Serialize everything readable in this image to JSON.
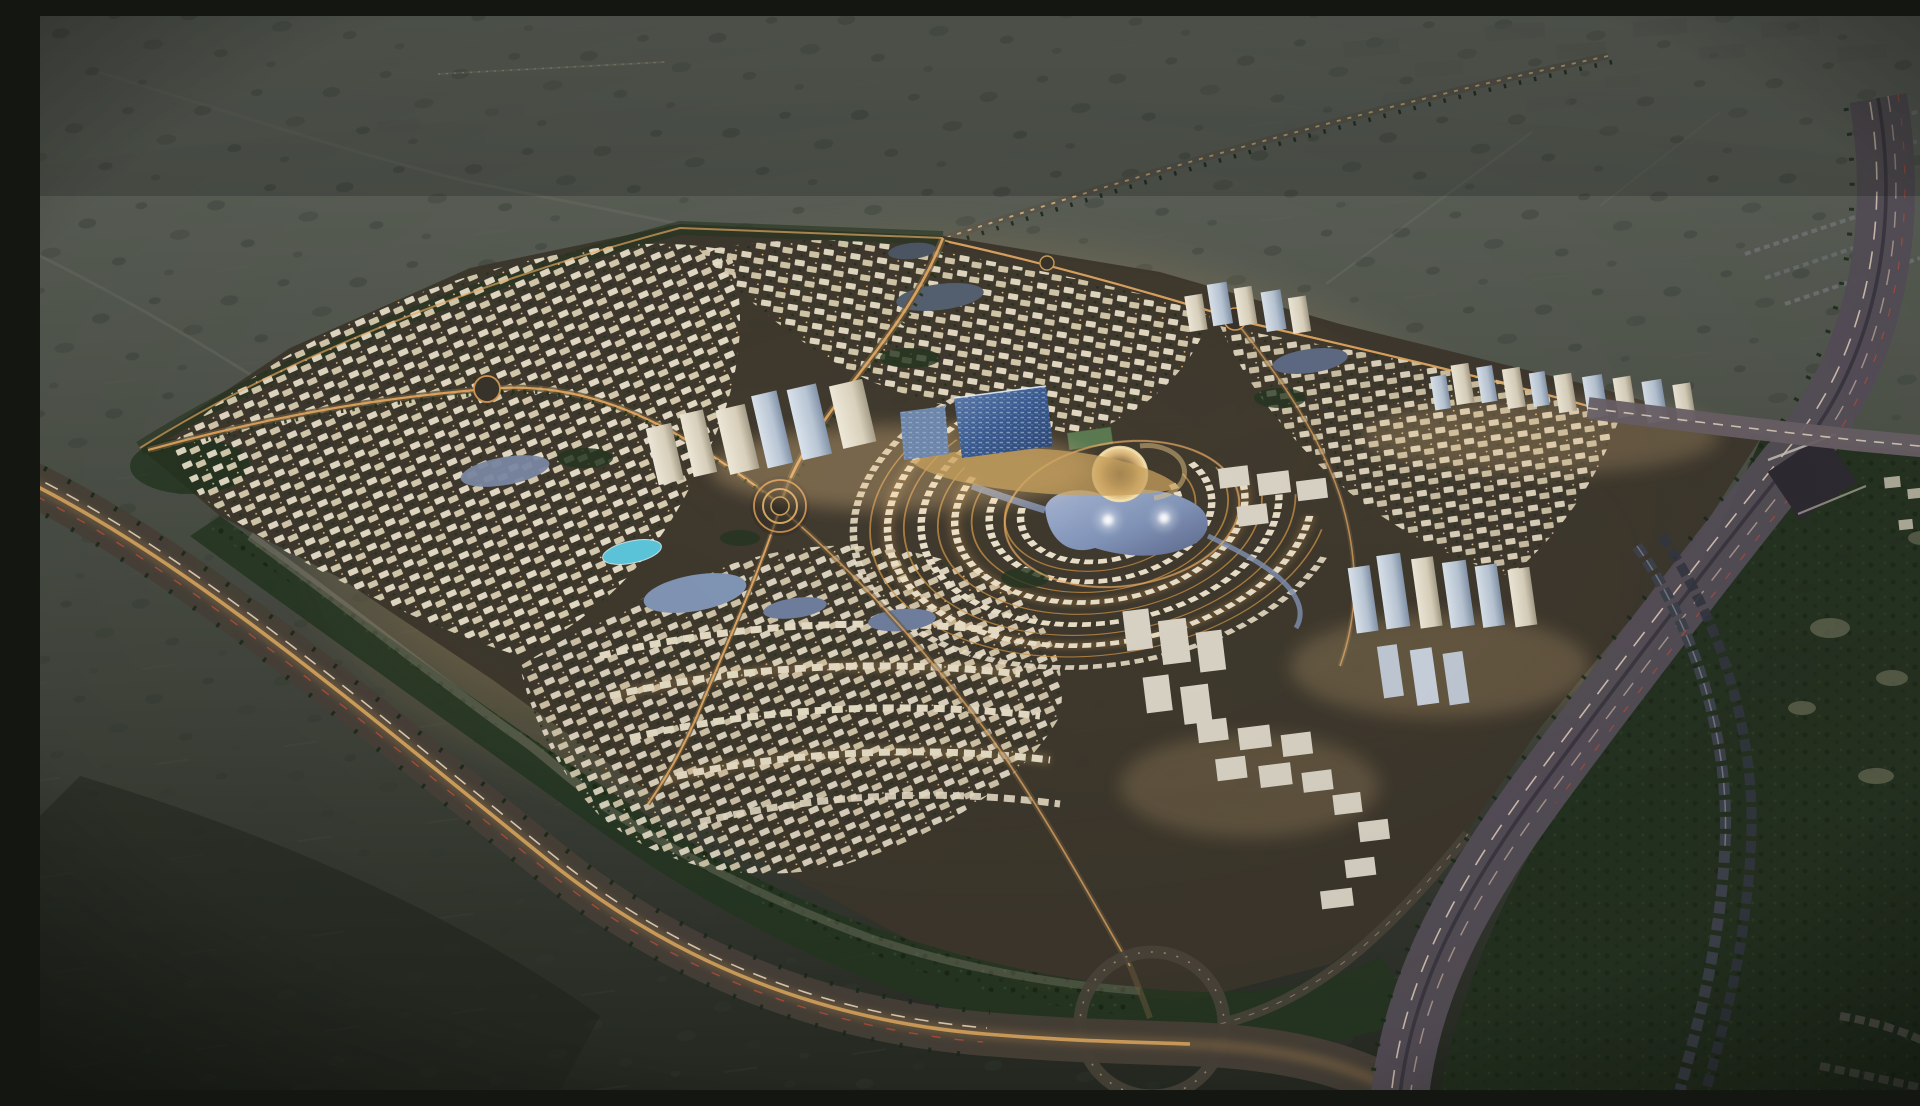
{
  "scene": {
    "description": "Aerial dusk rendering of a vast illuminated master-planned residential community in a dark desert plain, with a central lagoon, glass office towers, concentric crescents of villas, tree-lined boulevards, perimeter highways with an interchange loop and underpass, and a golf strip with townhouse rows on the east side",
    "time_of_day": "dusk",
    "setting": "desert",
    "features": [
      "desert plain with scrub",
      "distant industrial warehouses",
      "lit master-planned community",
      "central lagoon with glowing fountains",
      "blue glass office slab",
      "white residential tower clusters",
      "round amphitheatre building",
      "concentric villa crescents",
      "villa grid districts",
      "roundabouts",
      "turquoise swimming pool",
      "green belts and parks",
      "southwest lit highway",
      "eastern multi-lane highway",
      "cloverleaf ramp loop",
      "intersection with underpass",
      "golf course with sand bunkers",
      "townhouse rows",
      "estate homes"
    ]
  },
  "palette": {
    "desert-top": "#61655d",
    "desert-mid": "#4d5148",
    "desert-low": "#343830",
    "desert-deep": "#23271f",
    "scrub": "#39413a",
    "glow-warm": "#e9b469",
    "road-gold": "#f0b066",
    "light-warm": "#ffd494",
    "light-white": "#f7ecd4",
    "villa": "#efe6d0",
    "villa-shade": "#ddd0b4",
    "water": "#8fa0c2",
    "water-deep": "#5f6c8e",
    "pool": "#5ec9de",
    "green-dark": "#263722",
    "green-lit": "#4f6a33",
    "glass-blue": "#3f6096",
    "glass-light": "#cfe3f5",
    "tower-white": "#e9e4d6",
    "tower-shade": "#aaa18c",
    "tower-blue": "#c6d3e2",
    "asphalt": "#57505a",
    "asphalt-warm": "#4a423a",
    "taillight": "#c0503c",
    "headlight": "#f2dfc8",
    "berm": "#968e7e",
    "golf": "#243120",
    "bunker": "#6d7059",
    "distant": "#5b5f58"
  },
  "canvas": {
    "width": 1920,
    "height": 1074
  }
}
